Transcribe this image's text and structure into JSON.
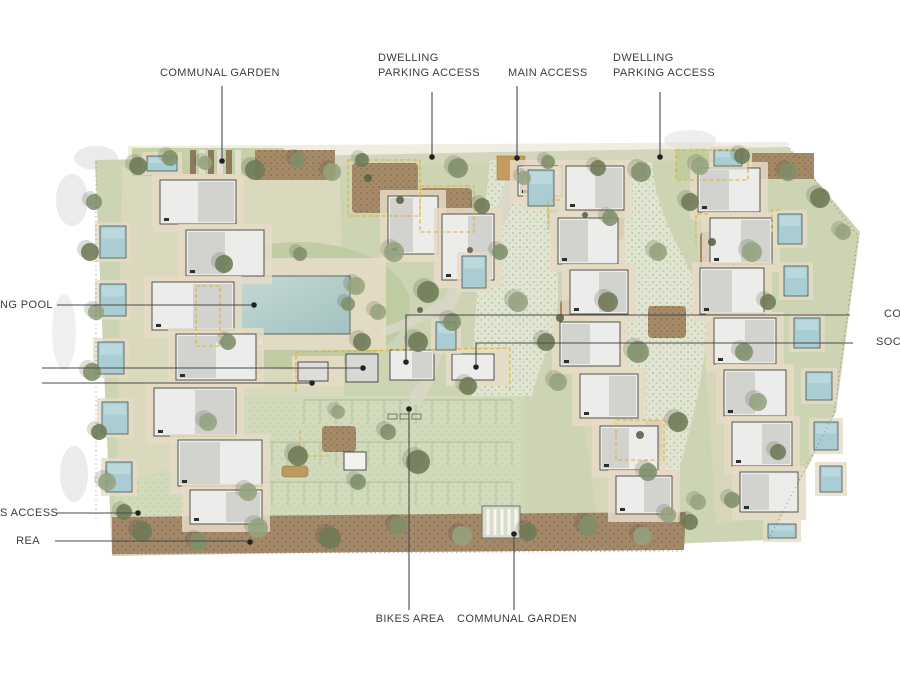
{
  "figure": {
    "type": "architectural site plan",
    "description": "Aerial rendered masterplan of a residential development with dwellings, private pools, communal swimming pool, gardens, central paths and a parking area"
  },
  "annotations": {
    "communal_garden_top": "COMMUNAL GARDEN",
    "dwelling_parking_access_left_line1": "DWELLING",
    "dwelling_parking_access_left_line2": "PARKING ACCESS",
    "main_access": "MAIN ACCESS",
    "dwelling_parking_access_right_line1": "DWELLING",
    "dwelling_parking_access_right_line2": "PARKING ACCESS",
    "swimming_pool_partial": "NG POOL",
    "co_partial": "CO",
    "soc_partial": "SOC",
    "access_partial": "S ACCESS",
    "area_partial": "REA",
    "bikes_area": "BIKES AREA",
    "communal_garden_bottom": "COMMUNAL GARDEN"
  },
  "colors": {
    "background": "#ffffff",
    "label_text": "#3c3c3c",
    "leader_line": "#4a4a4a",
    "site_green": "#ccd4b4",
    "lawn_green": "#bcc99c",
    "path_beige": "#e7dcc6",
    "cobble_path": "#e0e5d1",
    "mulch_brown": "#a58a68",
    "bottom_strip_brown": "#a3886a",
    "communal_pool": "#b3cdca",
    "private_pool": "#a9cdd3",
    "building_light": "#ececea",
    "building_mid": "#d2d2cf",
    "tree_green": "#6d7a55",
    "accent_yellow": "#d9b32e",
    "access_square_orange": "#c49552"
  }
}
